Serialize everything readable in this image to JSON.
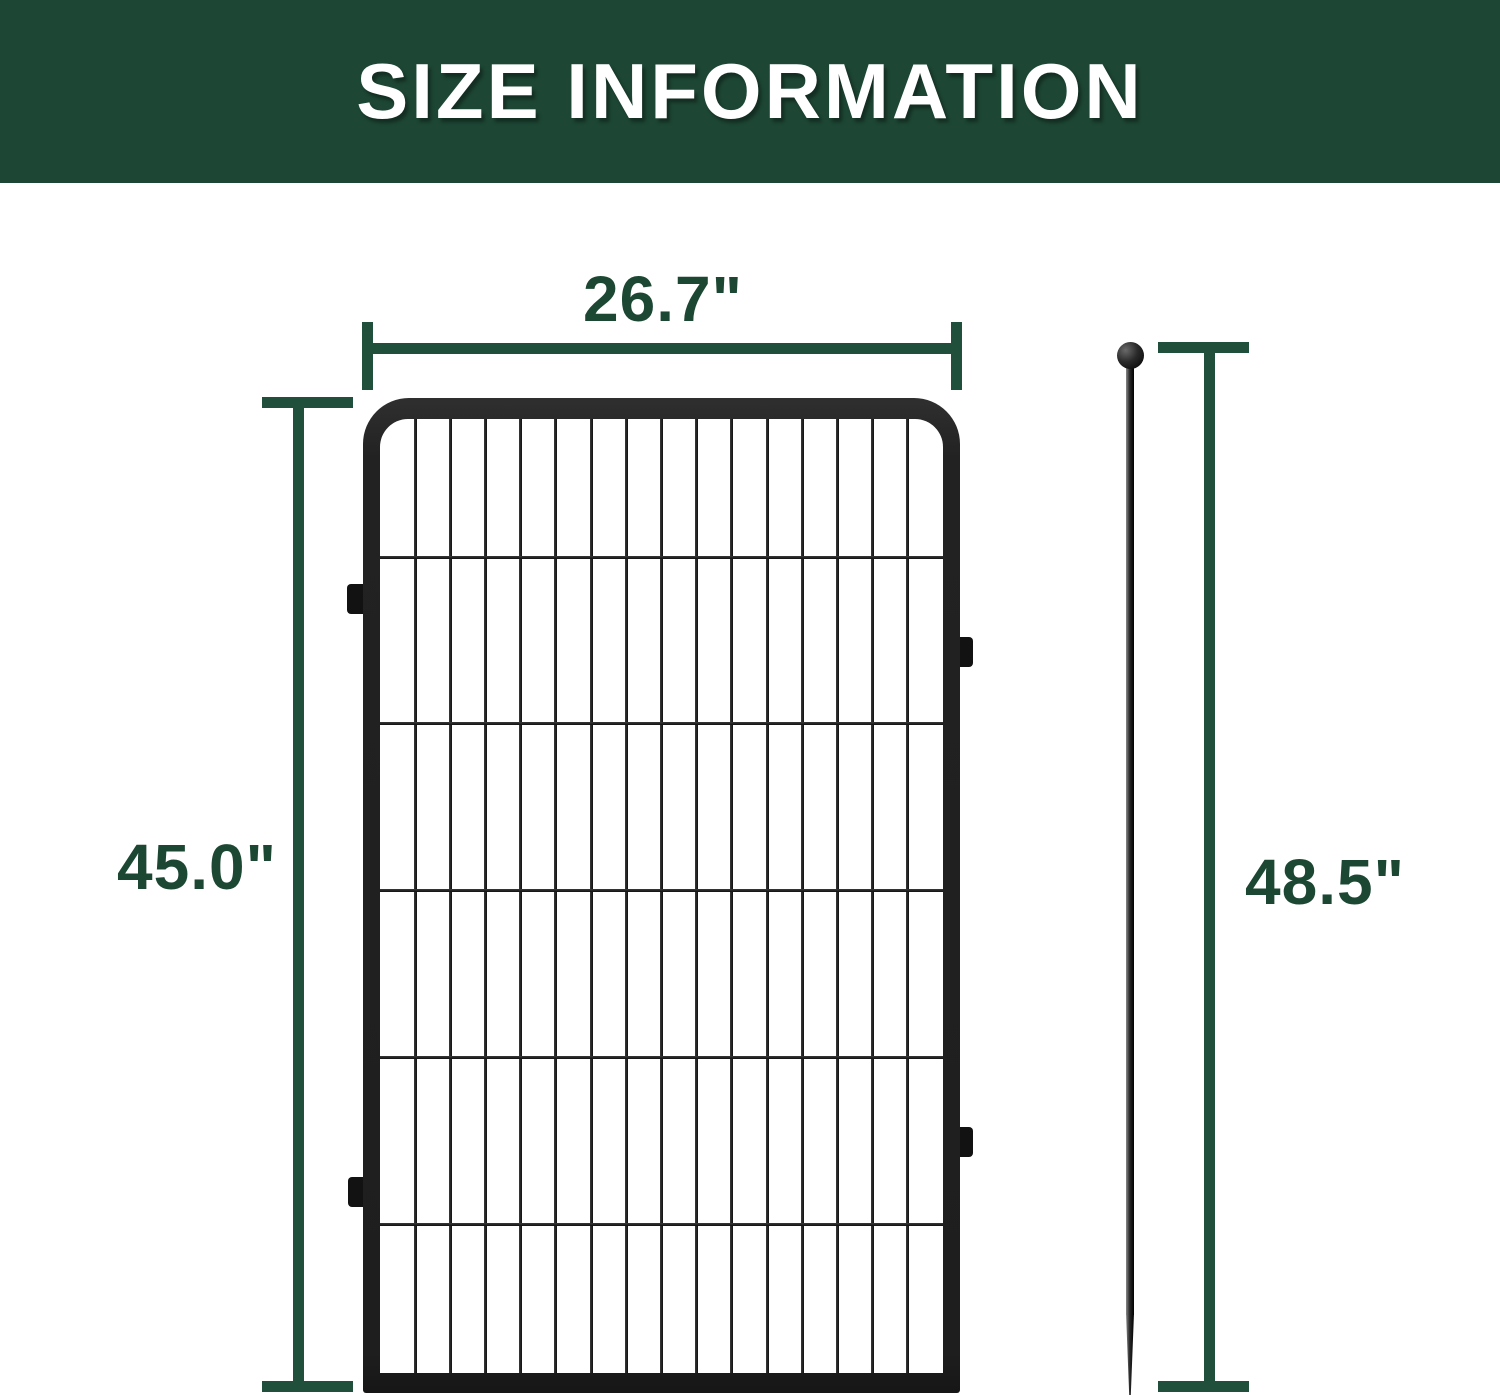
{
  "header": {
    "title": "SIZE INFORMATION"
  },
  "dimensions": {
    "panel_width": "26.7\"",
    "panel_height": "45.0\"",
    "stake_height": "48.5\""
  },
  "colors": {
    "banner_green": "#1d4634",
    "dimension_green": "#20503b",
    "label_green": "#1c4733",
    "fence_black": "#1e1e1e"
  }
}
